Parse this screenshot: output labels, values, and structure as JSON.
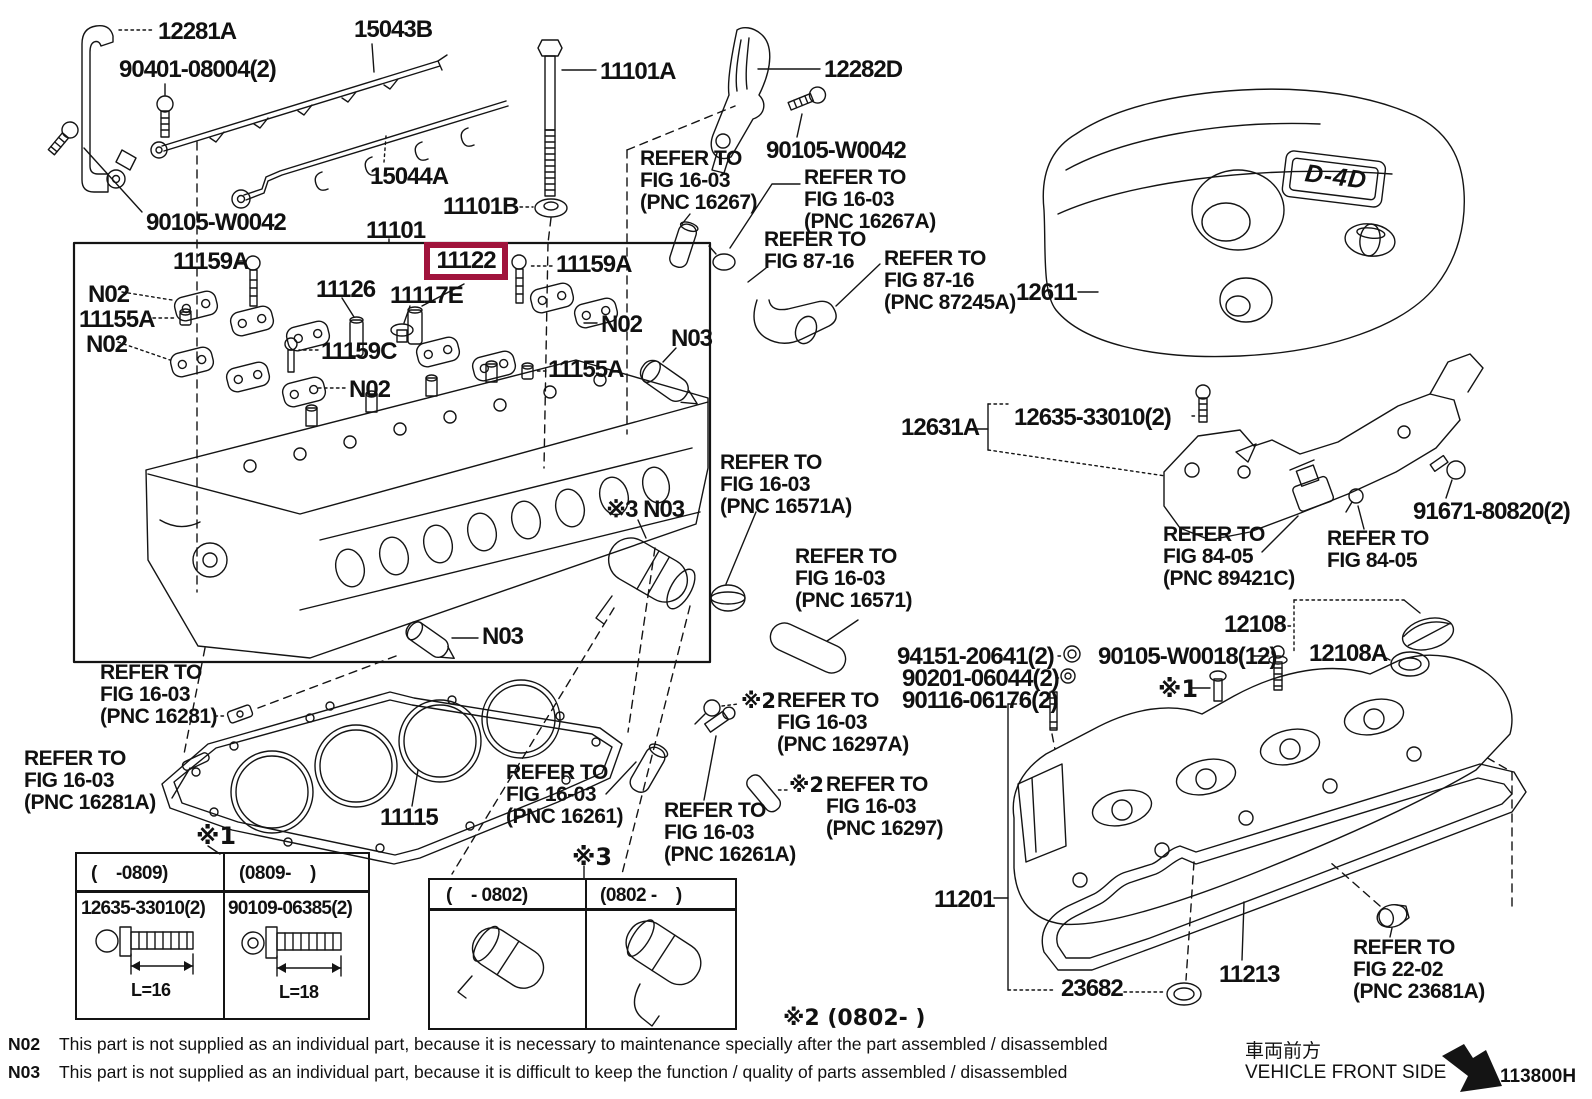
{
  "figure": {
    "highlight_color": "#a0143c",
    "line_color": "#141414"
  },
  "parts": {
    "p12281A": "12281A",
    "p90401": "90401-08004(2)",
    "p15043B": "15043B",
    "p15044A": "15044A",
    "p90105w0042": "90105-W0042",
    "p11101": "11101",
    "p11101A": "11101A",
    "p11101B": "11101B",
    "p12282D": "12282D",
    "p12611": "12611",
    "p11159A": "11159A",
    "p11159C": "11159C",
    "p11155A": "11155A",
    "p11126": "11126",
    "p11117E": "11117E",
    "p11122": "11122",
    "pN02": "N02",
    "pN03": "N03",
    "px3N03": "※3 N03",
    "p12631A": "12631A",
    "p12635": "12635-33010(2)",
    "p91671": "91671-80820(2)",
    "p12108": "12108",
    "p12108A": "12108A",
    "p94151": "94151-20641(2)",
    "p90201": "90201-06044(2)",
    "p90116": "90116-06176(2)",
    "p90105w0018": "90105-W0018(12)",
    "p11201": "11201",
    "p23682": "23682",
    "p11213": "11213",
    "p11115": "11115",
    "badge": "D-4D"
  },
  "refs": {
    "r16267": "REFER TO\nFIG 16-03\n(PNC 16267)",
    "r16267a": "REFER TO\nFIG 16-03\n(PNC 16267A)",
    "r8716": "REFER TO\nFIG 87-16",
    "r87245a": "REFER TO\nFIG 87-16\n(PNC 87245A)",
    "r16571a": "REFER TO\nFIG 16-03\n(PNC 16571A)",
    "r16571": "REFER TO\nFIG 16-03\n(PNC 16571)",
    "r89421c": "REFER TO\nFIG 84-05\n(PNC 89421C)",
    "r8405": "REFER TO\nFIG 84-05",
    "r16281": "REFER TO\nFIG 16-03\n(PNC 16281)",
    "r16281a": "REFER TO\nFIG 16-03\n(PNC 16281A)",
    "r16261": "REFER TO\nFIG 16-03\n(PNC 16261)",
    "r16261a": "REFER TO\nFIG 16-03\n(PNC 16261A)",
    "r16297a": "REFER TO\nFIG 16-03\n(PNC 16297A)",
    "r16297": "REFER TO\nFIG 16-03\n(PNC 16297)",
    "r2202": "REFER TO\nFIG 22-02\n(PNC 23681A)"
  },
  "marks": {
    "x1": "※1",
    "x2": "※2",
    "x3": "※3"
  },
  "tables": {
    "t1": {
      "col1_header": "(    -0809)",
      "col2_header": "(0809-    )",
      "col1_part": "12635-33010(2)",
      "col2_part": "90109-06385(2)",
      "col1_dim": "L=16",
      "col2_dim": "L=18"
    },
    "t3": {
      "col1_header": "(    - 0802)",
      "col2_header": "(0802 -    )"
    },
    "x2_note": "※2 (0802-    )"
  },
  "notes": [
    {
      "code": "N02",
      "text": "This part is not supplied as an individual part, because it is necessary to maintenance specially after the part assembled / disassembled"
    },
    {
      "code": "N03",
      "text": "This part is not supplied as an individual part, because it is difficult to keep the function / quality of parts  assembled / disassembled"
    }
  ],
  "footer": {
    "kanji": "車両前方",
    "front": "VEHICLE FRONT SIDE",
    "code": "113800H"
  }
}
